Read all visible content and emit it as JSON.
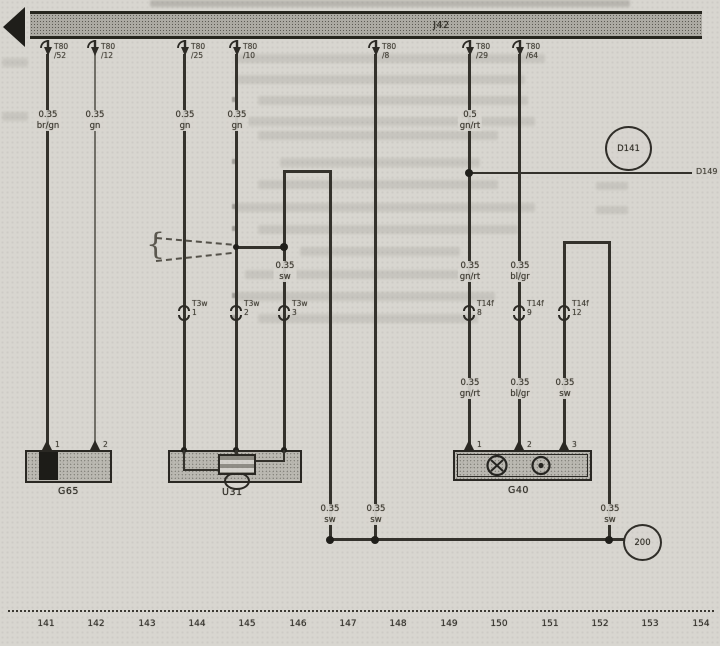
{
  "bus": {
    "label": "J42"
  },
  "top_connectors": [
    {
      "name": "T80",
      "pin": "/52"
    },
    {
      "name": "T80",
      "pin": "/12"
    },
    {
      "name": "T80",
      "pin": "/25"
    },
    {
      "name": "T80",
      "pin": "/10"
    },
    {
      "name": "T80",
      "pin": "/8"
    },
    {
      "name": "T80",
      "pin": "/29"
    },
    {
      "name": "T80",
      "pin": "/64"
    }
  ],
  "wire_labels": [
    {
      "gauge": "0.35",
      "color": "br/gn"
    },
    {
      "gauge": "0.35",
      "color": "gn"
    },
    {
      "gauge": "0.35",
      "color": "gn"
    },
    {
      "gauge": "0.35",
      "color": "gn"
    },
    {
      "gauge": "0.5",
      "color": "gn/rt"
    },
    {
      "gauge": "0.35",
      "color": "sw"
    },
    {
      "gauge": "0.35",
      "color": "gn/rt"
    },
    {
      "gauge": "0.35",
      "color": "bl/gr"
    },
    {
      "gauge": "0.35",
      "color": "gn/rt"
    },
    {
      "gauge": "0.35",
      "color": "bl/gr"
    },
    {
      "gauge": "0.35",
      "color": "sw"
    },
    {
      "gauge": "0.35",
      "color": "sw"
    },
    {
      "gauge": "0.35",
      "color": "sw"
    },
    {
      "gauge": "0.35",
      "color": "sw"
    }
  ],
  "inline_connectors": [
    {
      "name": "T3w",
      "pin": "1"
    },
    {
      "name": "T3w",
      "pin": "2"
    },
    {
      "name": "T3w",
      "pin": "3"
    },
    {
      "name": "T14f",
      "pin": "8"
    },
    {
      "name": "T14f",
      "pin": "9"
    },
    {
      "name": "T14f",
      "pin": "12"
    }
  ],
  "components": {
    "g65": {
      "label": "G65",
      "terminals": [
        "1",
        "2"
      ]
    },
    "u31": {
      "label": "U31"
    },
    "g40": {
      "label": "G40",
      "terminals": [
        "1",
        "2",
        "3"
      ]
    }
  },
  "references": {
    "d141": "D141",
    "d149": "D149",
    "ground": "200"
  },
  "ruler": {
    "ticks": [
      "141",
      "142",
      "143",
      "144",
      "145",
      "146",
      "147",
      "148",
      "149",
      "150",
      "151",
      "152",
      "153",
      "154"
    ]
  }
}
